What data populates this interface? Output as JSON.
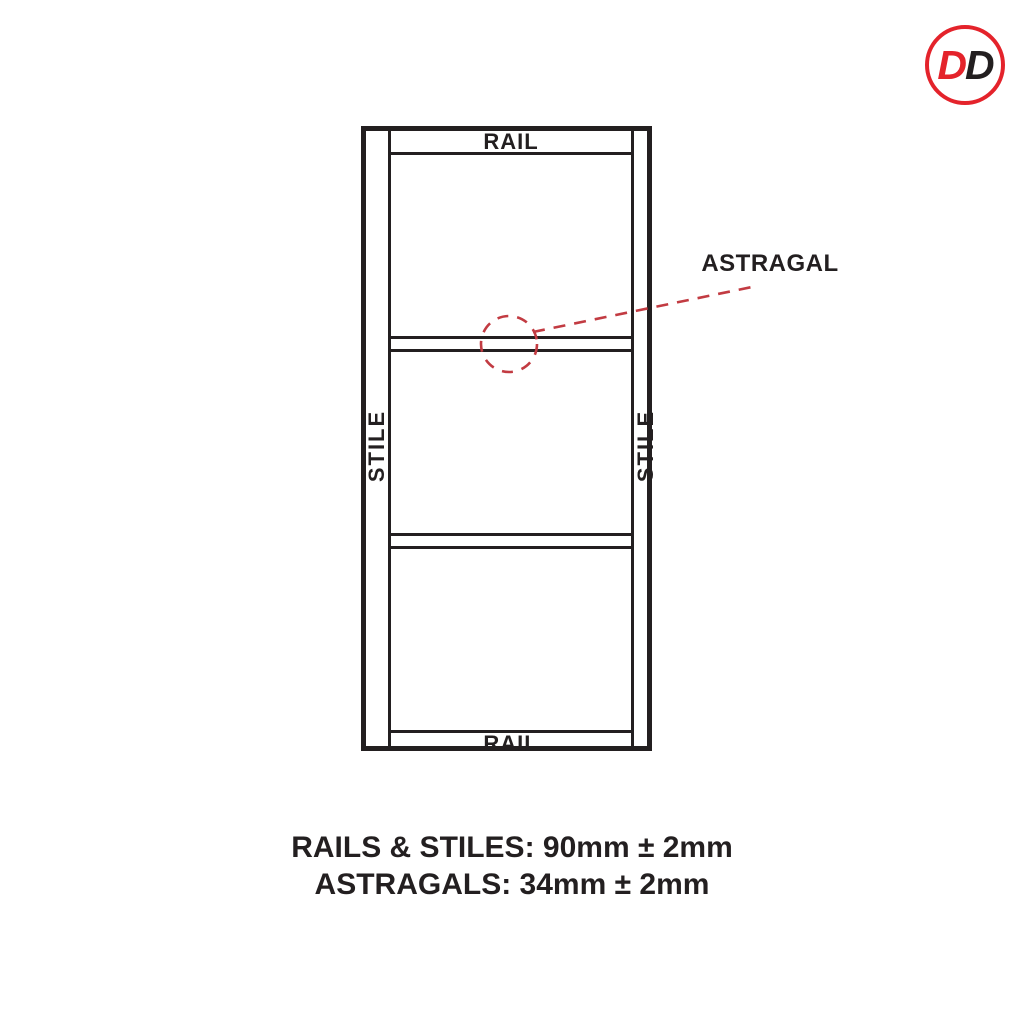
{
  "logo": {
    "letters": {
      "first": "D",
      "second": "D"
    },
    "colors": {
      "ring": "#e4232b",
      "first": "#e4232b",
      "second": "#231f20"
    }
  },
  "diagram": {
    "labels": {
      "rail_top": "RAIL",
      "rail_bottom": "RAIL",
      "stile_left": "STILE",
      "stile_right": "STILE",
      "astragal": "ASTRAGAL"
    },
    "colors": {
      "line": "#231f20",
      "annotation_red": "#c23b42"
    }
  },
  "notes": {
    "rails_stiles": "RAILS & STILES: 90mm ± 2mm",
    "astragals": "ASTRAGALS: 34mm ± 2mm"
  }
}
